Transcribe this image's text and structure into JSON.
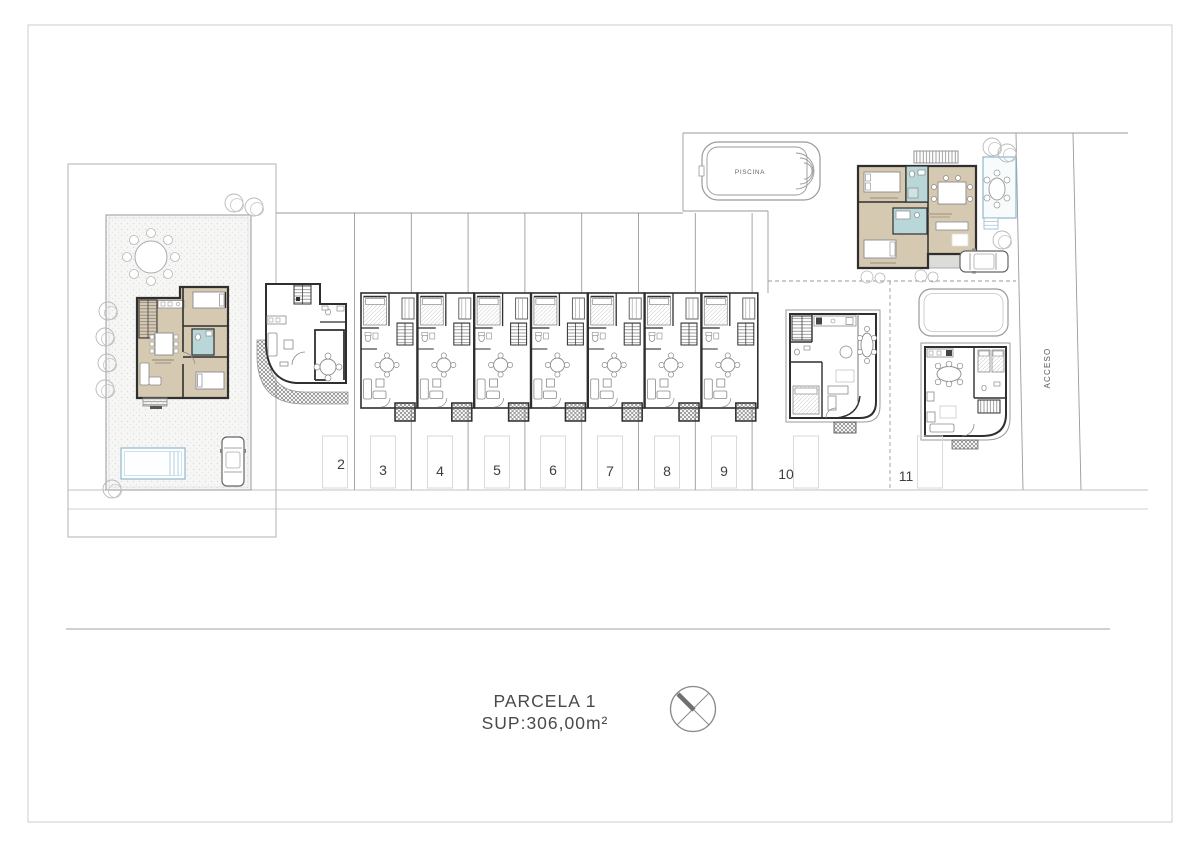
{
  "labels": {
    "title": "PARCELA 1",
    "area": "SUP:306,00m²",
    "piscina": "PISCINA",
    "acceso": "ACCESO"
  },
  "parcels": {
    "numbers": [
      "2",
      "3",
      "4",
      "5",
      "6",
      "7",
      "8",
      "9",
      "10",
      "11"
    ]
  },
  "colors": {
    "wall": "#2f2f2f",
    "room_beige": "#d6c9b2",
    "bath_blue": "#b9d6d8",
    "pool_blue": "#8fb8cc",
    "boundary_gray": "#9a9a9a",
    "road_gray": "#c2c2c2",
    "furniture_gray": "#8a8a8a"
  }
}
